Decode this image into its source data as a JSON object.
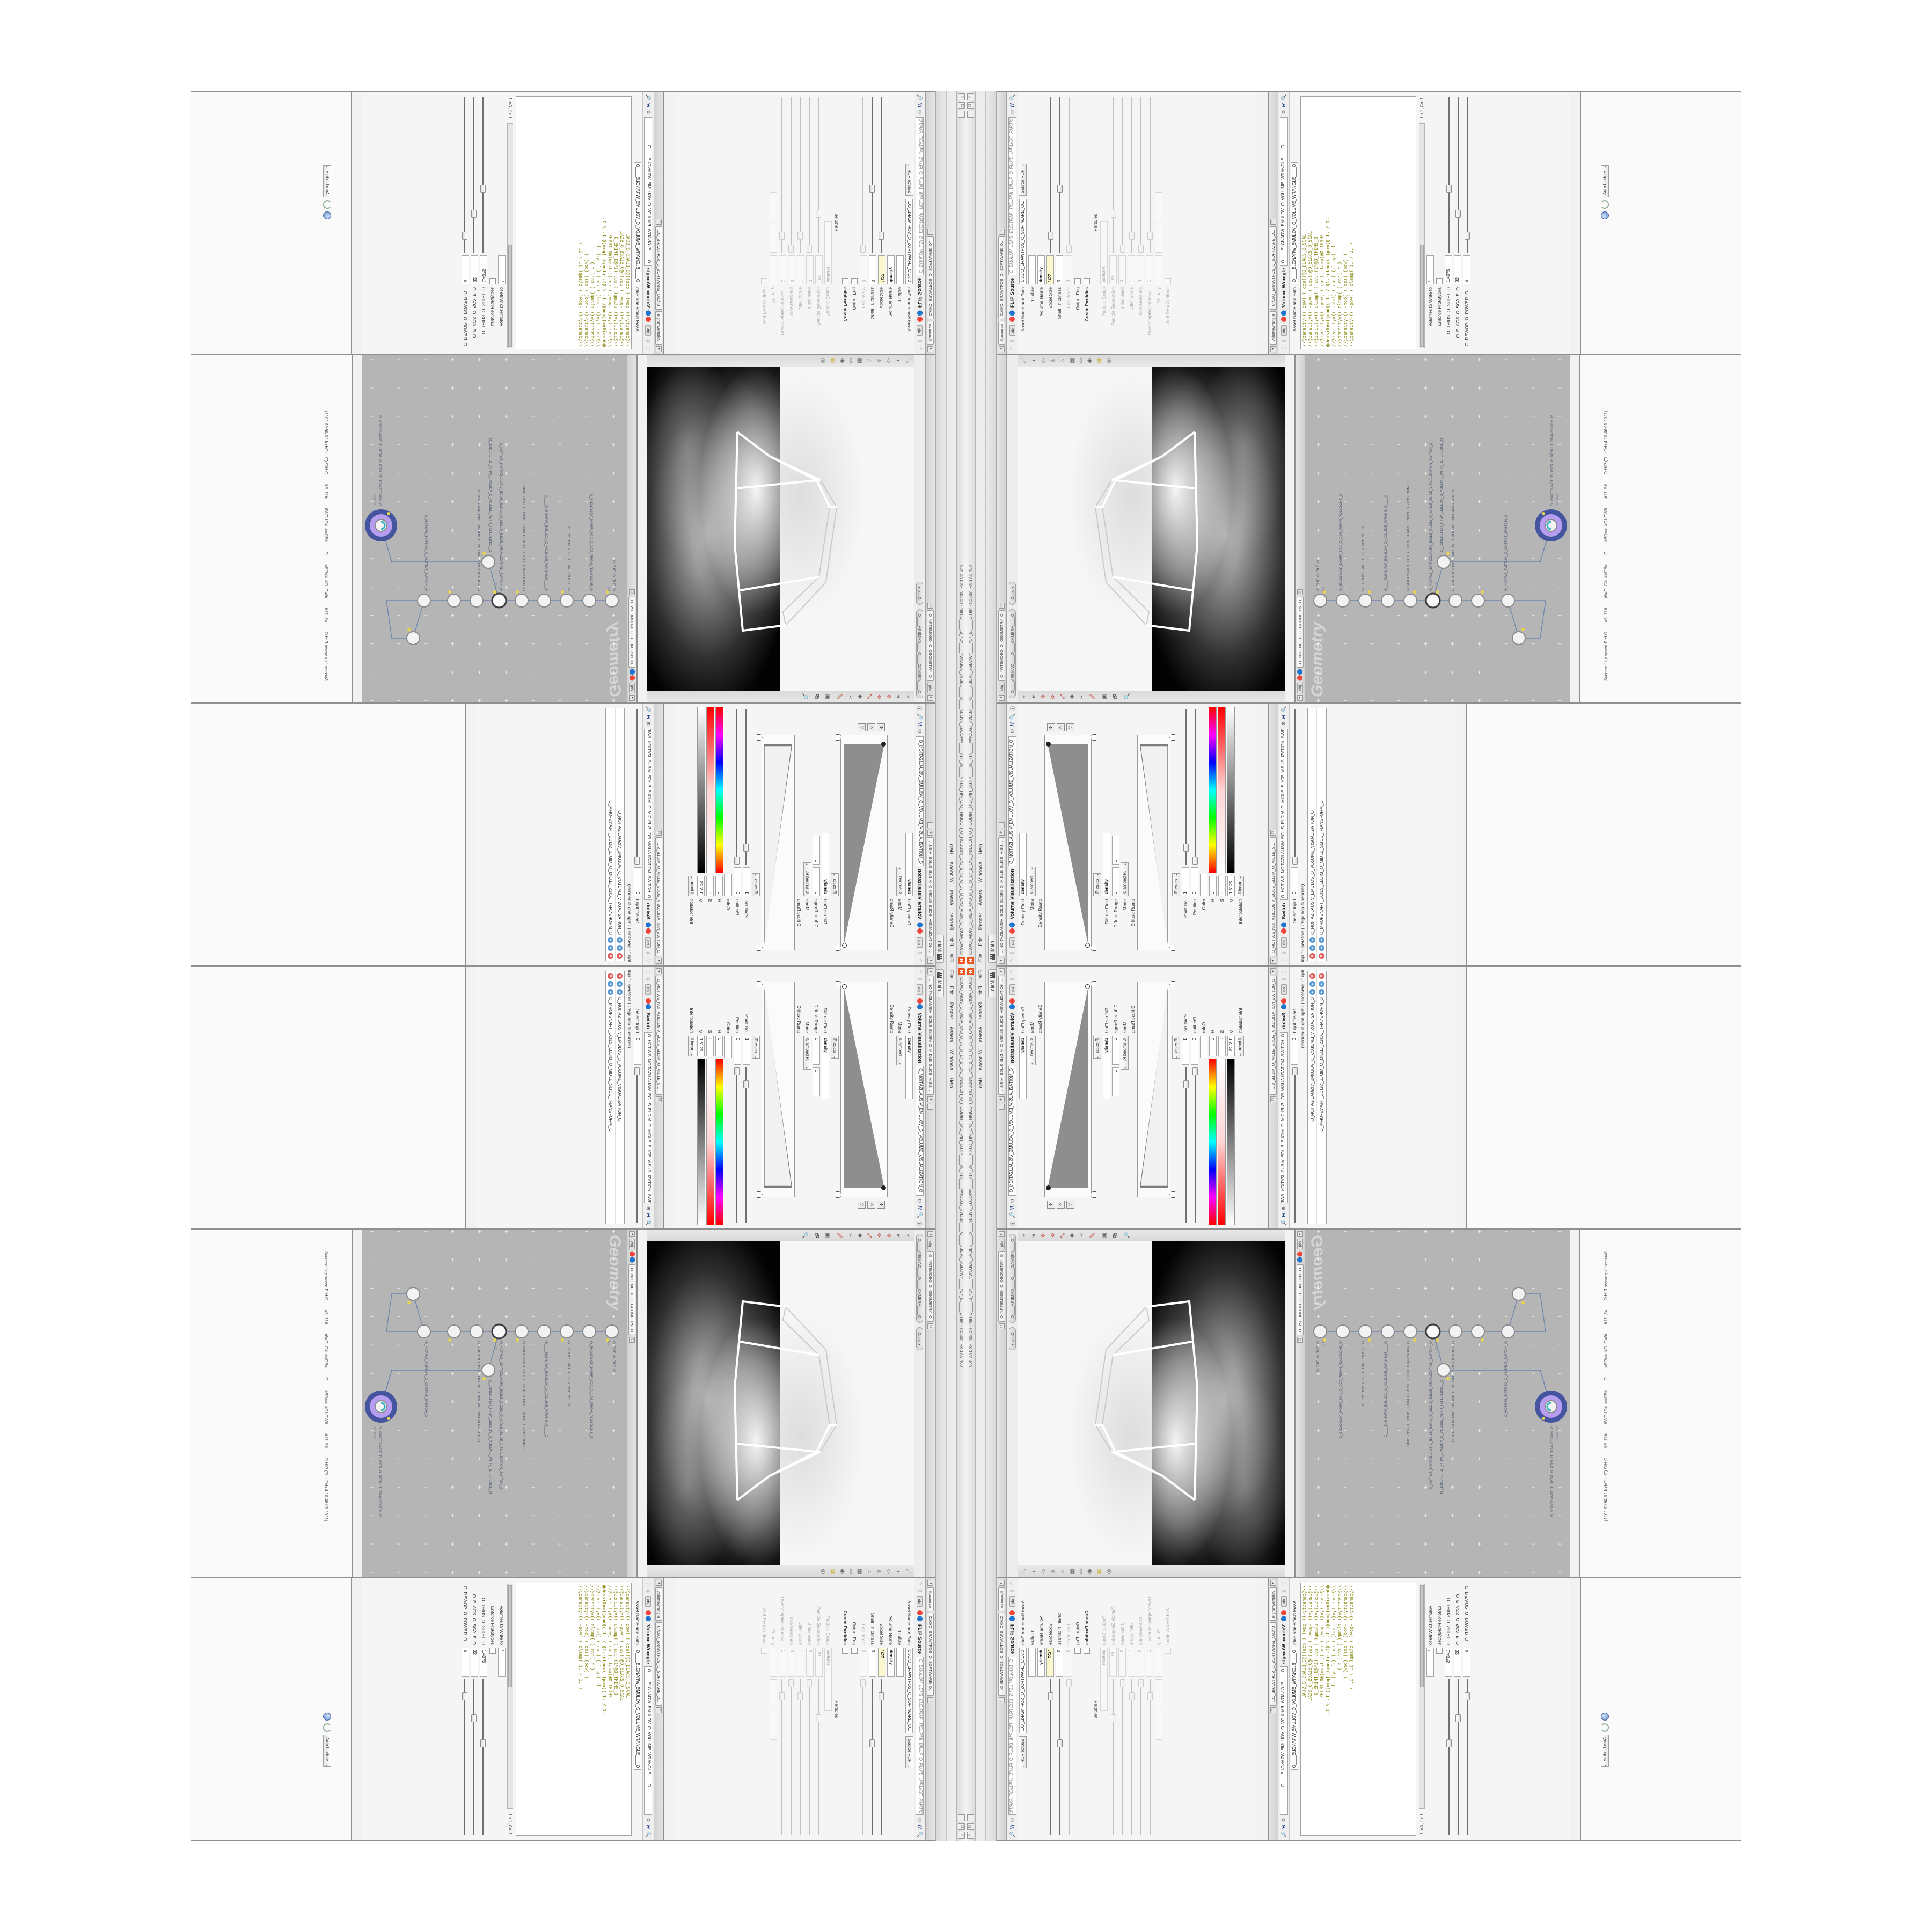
{
  "colors": {
    "accent_orange": "#e95420",
    "pane_bg": "#f2f2f2",
    "network_bg": "#b5b5b5",
    "node_select_outer": "#44549e",
    "node_select_inner": "#b79df0",
    "flag_yellow": "#e8d44d",
    "delete_red": "#e05d5d",
    "input_blue": "#5b9bd5",
    "code_olive": "#8a8a14",
    "code_teal": "#1e8d8d",
    "field_yellow": "#fbf8cf"
  },
  "app": {
    "title": "C:\\O\\O_AIDIV_O_VIDIA_O\\O_B_71_O_17_B_O\\O_INIDUOH_O_HOUDINI_O\\O_PIH_O.HIP____#5_71#____#WOLG#_#VDB#____O____#BDV#_#GLOW#____#17_5#____O.HIP - Houdini FX 17.5.460",
    "logo_letter": "H",
    "menu": [
      "File",
      "Edit",
      "Render",
      "Assets",
      "Windows",
      "Help"
    ],
    "window_controls": {
      "minimize": "—",
      "restore": "❐",
      "close": "✕"
    },
    "desktop_tab": "Main",
    "status_message": "Successfully saved PIH.O____#5_71#____#WOLG#_#VDB#____O____#BDV#_#GLOW#____#17_5#____O.HIP (Thu Feb 4 10:46:01 2021)"
  },
  "pane_common": {
    "obj_chip": "obj",
    "path_tab": "C:/O/O_ERAWTFOS_O_SOFTWARE_O...",
    "geometry_path": "O_YRTEMOEG_O_GEOMETRY_O"
  },
  "volume_visualization": {
    "tab": "....NOITAZILAUSIV_ECILS_ELDIM_O_MIDLE_SLICE_VISUAL....",
    "title": "Volume Visualization",
    "node_name": "O_NOITAZILAUSIV_EMULOV_O_VOLUME_VISUALIZATION_O",
    "density_field_label": "Density Field",
    "density_field_value": "density",
    "mode_label": "Mode",
    "mode_value": "Clamped...",
    "density_ramp_label": "Density Ramp",
    "presets_label": "Presets",
    "diffuse_field_label": "Diffuse Field",
    "diffuse_field_value": "density",
    "diffuse_range_label": "Diffuse Range",
    "diffuse_range_min": "0",
    "diffuse_range_max": "1",
    "diffuse_mode_label": "Mode",
    "diffuse_mode_value": "Clamped R...",
    "diffuse_ramp_label": "Diffuse Ramp",
    "point_no_label": "Point No.",
    "point_no_value": "1",
    "position_label": "Position",
    "position_value": "0",
    "color_label": "Color",
    "h_label": "H",
    "h_value": "0",
    "s_label": "S",
    "s_value": "0",
    "v_label": "V",
    "v_value": "1.8125",
    "interpolation_label": "Interpolation",
    "interpolation_value": "Linear"
  },
  "switch_pane": {
    "title": "Switch",
    "node_name": "O_HCTIWS_NOITAZILAUSIV_ECILS_ELDIM_O_MIDLE_SLICE_VISUALIZATION_SWITCH_O",
    "select_input_label": "Select Input",
    "select_input_value": "0",
    "list_label": "Input Operators (Drag/Drop to reorder)",
    "items": [
      {
        "label": "O_NOITAZILAUSIV_EMULOV_O_VOLUME_VISUALIZATION_O"
      },
      {
        "label": "O_MROFSNART_ECILS_ELDIM_O_MIDLE_SLICE_TRANSFORM_O"
      }
    ]
  },
  "viewport": {
    "camera_pill": "O____AREMAC____O____CAMERA____O",
    "ortho_label": "Ortho ▾",
    "left_tools": [
      {
        "name": "view-tool-icon",
        "glyph": "⌖"
      },
      {
        "name": "select-arrow-icon",
        "glyph": "➤"
      },
      {
        "name": "translate-icon",
        "glyph": "✥"
      },
      {
        "name": "rotate-icon",
        "glyph": "⟳"
      },
      {
        "name": "scale-icon",
        "glyph": "⤢"
      },
      {
        "name": "snap-icon",
        "glyph": "✱"
      },
      {
        "name": "scissors-icon",
        "glyph": "✂"
      },
      {
        "name": "paint-icon",
        "glyph": "🖉"
      },
      {
        "name": "render-region-icon",
        "glyph": "▣"
      },
      {
        "name": "flipbook-icon",
        "glyph": "🗗"
      },
      {
        "name": "magnify-icon",
        "glyph": "🔍"
      }
    ],
    "right_tools": [
      {
        "name": "comet-icon",
        "glyph": "☄"
      },
      {
        "name": "shade-sphere-icon",
        "glyph": "◑"
      },
      {
        "name": "wireframe-icon",
        "glyph": "◇"
      },
      {
        "name": "normals-icon",
        "glyph": "⋔"
      },
      {
        "name": "points-icon",
        "glyph": "∴"
      },
      {
        "name": "texture-icon",
        "glyph": "▦"
      },
      {
        "name": "abc-icon",
        "glyph": "ab"
      },
      {
        "name": "lens-icon",
        "glyph": "◉"
      },
      {
        "name": "quadview-icon",
        "glyph": "⊞"
      },
      {
        "name": "eye-icon",
        "glyph": "👁"
      }
    ]
  },
  "network": {
    "watermark": "Geometry",
    "breadcrumb": "O_YRTEMOEG_O_GEOMETRY_O",
    "nodes": [
      {
        "label": "file",
        "name": "O_ELIF_O_FILE_O"
      },
      {
        "label": "vdbfrompolygons",
        "name": "O_SNOGYLOP_MORF_BDV_O_VDB_FROM_POLYGONS_O"
      },
      {
        "label": "flipsource",
        "name": "O_ECRUOS_PILF_O_FLIP_SOURCE_O"
      },
      {
        "label": "volumewrangle",
        "name": "O____ELGNARW_EMULOV_O_VOLUME_WRANGLE____O"
      },
      {
        "label": "transform",
        "name": "O_MROFSNART_ECILS_ELDIM_O_MIDLE_SLICE_TRANSFORM_O"
      },
      {
        "label": "switch",
        "name": "O_HCTIWS_NOITAZILAUSIV_ECILS_ELDIM_O_MIDLE_SLICE_VISUALIZATION_SWITCH_O"
      },
      {
        "label": "visualize",
        "name": "O_NOITAZILAUSIV_EMULOV_O_VOLUME_VISUALIZATION_O"
      },
      {
        "label": "merge",
        "name": "O_ECNEREFER_HTIW_EMULOV_O_VOLUME_WITH_REFERENCE_O"
      },
      {
        "label": "transform",
        "name": "O_MROFSNART_TLUSER_O_RESULT_TRANSFORM_O"
      },
      {
        "label": "switch",
        "name": "O_HCTIWS_TUPTUO_O_OUTPUT_SWITCH_O"
      }
    ]
  },
  "flip_source": {
    "tab": "flipsource",
    "title": "FLIP Source",
    "node_name": "O_EMULOV_LEHS_ELCITRAP_TICILPMI_DIULF_O_FLUID_IMPLICIT_PARTICLE_SHEL_VOLUME_O",
    "asset_label": "Asset Name and Path",
    "asset_value": "C:/O/O_ERAWTFOS_O_SOFTWARE_O...",
    "asset_mode": "Source FLIP",
    "initialize_label": "Initialize",
    "volume_name_label": "Volume Name",
    "volume_name_value": "density",
    "voxel_size_label": "Voxel Size",
    "voxel_size_value": "1/27",
    "shell_thickness_label": "Shell Thickness",
    "shell_thickness_value": "3",
    "fog_boost_label": "Fog Boost",
    "fog_boost_value": "0",
    "output_fog_label": "Output Fog",
    "create_particles_label": "Create Particles",
    "particles_section": "Particles",
    "particle_group_label": "Particle Group",
    "particle_group_value": "particles",
    "particle_separation_label": "Particle Separation",
    "particle_separation_value": "1/9",
    "jitter_seed_label": "Jitter Seed",
    "jitter_seed_value": "0",
    "jitter_scale_label": "Jitter Scale",
    "jitter_scale_value": "1",
    "oversampling_label": "Oversampling",
    "oversampling_value": "0",
    "oversampling_bw_label": "Oversampling Bandwi...",
    "oversampling_bw_value": "1",
    "velocity_label": "Velocity",
    "add_rest_label": "Add Rest Attribute"
  },
  "volume_wrangle": {
    "tab": "volumewrangle",
    "title": "Volume Wrangle",
    "node_name": "O____ELGNARW_EMULOV_O_VOLUME_WRANGLE____O",
    "asset_label": "Asset Name and Path",
    "code_lines": [
      "//@density=(( pow( ( cos((@O_ELACS_O_SCAL",
      "//@density=(( -pow( ( cos((@O_ELACS_O_SCAL",
      "//@density=(( clamp( ( cos((1*@O_TFIHS_O",
      "//@density=(( -pow( ( cos((clamp(@O_TFIHS",
      "@density=((mod(( 1. / (1.-clamp( (pow(( 1. / 1.",
      "//@density=(( -mod( ( cos( (clamp( cl",
      "//@density=(( clamp( ( cos( c )",
      "//@density=(( -mod( ( cos( (pow) )",
      "//@density=(( -pow( ( clamp( 1. / 1. )"
    ],
    "ln_col": "Ln 1, Col 1",
    "volumes_label": "Volumes to Write to",
    "volumes_value": "*",
    "enforce_label": "Enforce Prototypes",
    "spare_params": [
      {
        "label": "O_TFIHS_O_SHIFT_O",
        "value": "1.4375"
      },
      {
        "label": "O_ELACS_O_SCALE_O",
        "value": "32"
      },
      {
        "label": "O_REWOP_O_POWER_O...",
        "value": "6"
      }
    ],
    "auto_update_label": "Auto Update"
  }
}
